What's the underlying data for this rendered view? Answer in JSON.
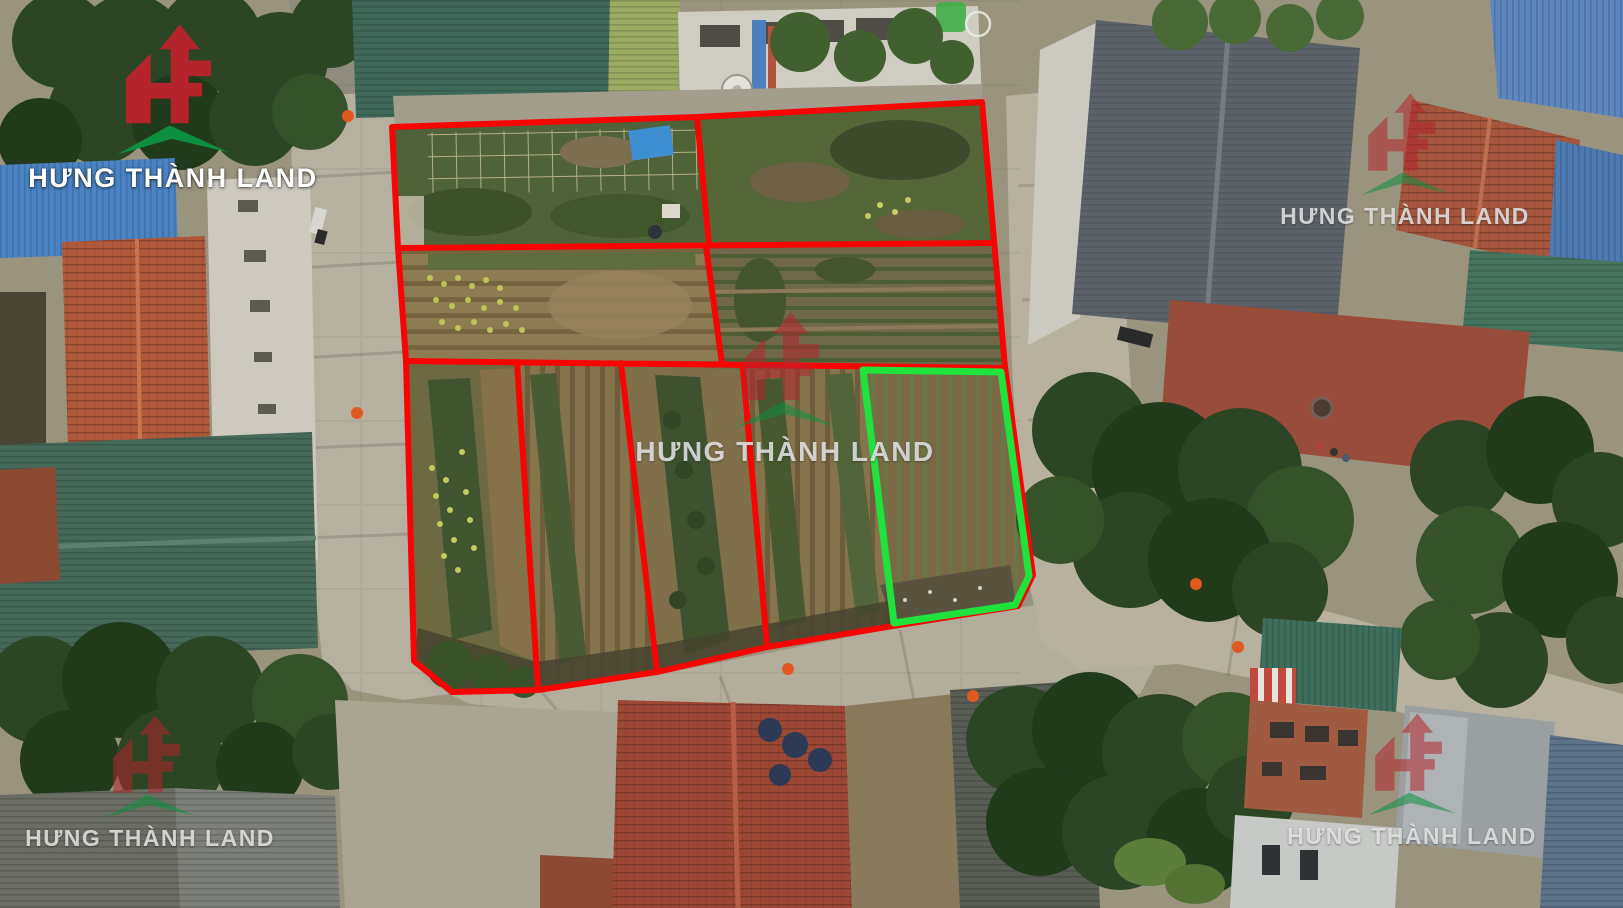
{
  "brand": {
    "name": "HƯNG THÀNH LAND"
  },
  "colors": {
    "plot_outline_red": "#f70505",
    "plot_outline_green": "#1fe23c",
    "logo_red": "#b5242b",
    "logo_roof_green": "#0c8f3f",
    "logo_text_white": "#ffffff",
    "traffic_cone_orange": "#e05a1f"
  },
  "plots": {
    "red_outlined_count": 8,
    "green_outlined_count": 1
  }
}
